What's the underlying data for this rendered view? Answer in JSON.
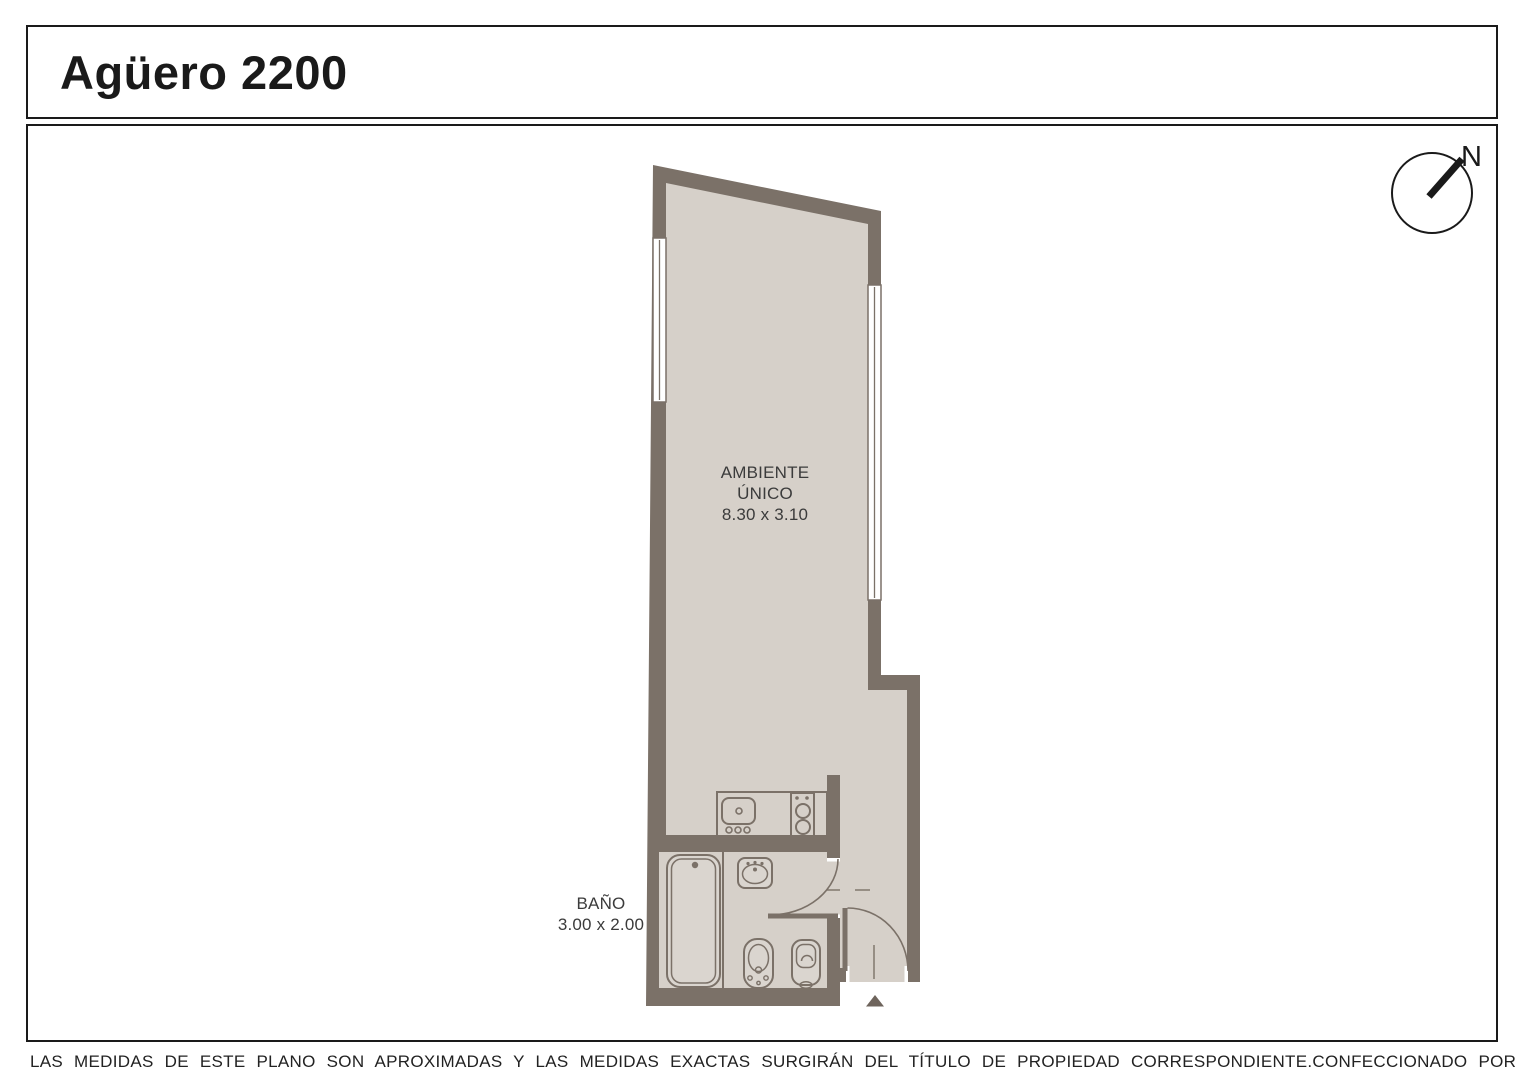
{
  "page": {
    "title": "Agüero 2200",
    "compass_label": "N"
  },
  "rooms": {
    "main": {
      "name_line1": "AMBIENTE",
      "name_line2": "ÚNICO",
      "dimensions": "8.30 x 3.10"
    },
    "bathroom": {
      "name": "BAÑO",
      "dimensions": "3.00 x 2.00"
    }
  },
  "footer": {
    "disclaimer": "LAS MEDIDAS  DE ESTE PLANO SON APROXIMADAS Y LAS MEDIDAS EXACTAS SURGIRÁN DEL TÍTULO DE PROPIEDAD CORRESPONDIENTE.",
    "credit": "CONFECCIONADO POR ESTUDIO NARTEX"
  },
  "colors": {
    "wall": "#7b7168",
    "floor": "#d6d0c9",
    "fixture": "#dad5cf",
    "triangle": "#6e645c",
    "ink": "#1a1a1a"
  }
}
